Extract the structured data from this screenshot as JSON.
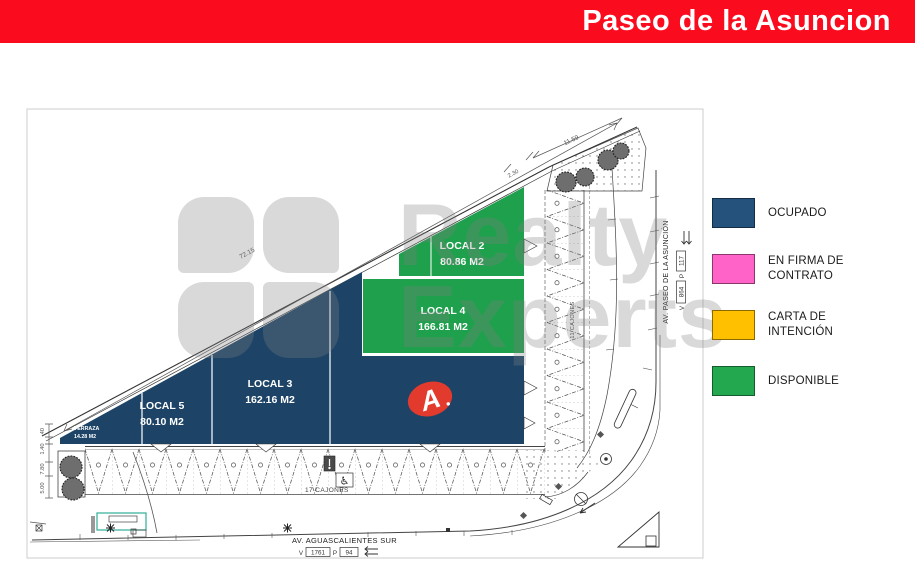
{
  "header": {
    "title": "Paseo de la Asuncion"
  },
  "palette": {
    "header_red": "#FA0C1E",
    "occupied": "#1D4467",
    "available": "#1FA04D",
    "logo_red": "#E23B2E"
  },
  "watermark": {
    "line1": "Realty",
    "line2": "Experts"
  },
  "legend": {
    "items": [
      {
        "label": "OCUPADO",
        "color": "#24527C"
      },
      {
        "label": "EN FIRMA DE CONTRATO",
        "color": "#FF63C8"
      },
      {
        "label": "CARTA DE INTENCIÓN",
        "color": "#FFC000"
      },
      {
        "label": "DISPONIBLE",
        "color": "#23A84F"
      }
    ]
  },
  "locals": {
    "l2": {
      "name": "LOCAL 2",
      "area": "80.86 M2"
    },
    "l4": {
      "name": "LOCAL 4",
      "area": "166.81 M2"
    },
    "l3": {
      "name": "LOCAL 3",
      "area": "162.16 M2"
    },
    "l5": {
      "name": "LOCAL 5",
      "area": "80.10 M2"
    },
    "terraza": {
      "name": "TERRAZA",
      "area": "14.28 M2"
    },
    "anchor": {
      "letter": "A"
    }
  },
  "dims": {
    "boundary": "72.15",
    "gap": "2.30",
    "frontage": "11.59",
    "left": [
      ".40",
      "1.40",
      "7.80",
      "5.00"
    ]
  },
  "parking": {
    "bottom": "17 CAJONES",
    "side": "11 CAJONES"
  },
  "streets": {
    "bottom": {
      "name": "AV. AGUASCALIENTES SUR",
      "v_label": "V",
      "v_value": "1761",
      "p_label": "P",
      "p_value": "94"
    },
    "right": {
      "name": "AV. PASEO DE LA ASUNCIÓN",
      "v_label": "V",
      "v_value": "864",
      "p_label": "P",
      "p_value": "117"
    }
  }
}
